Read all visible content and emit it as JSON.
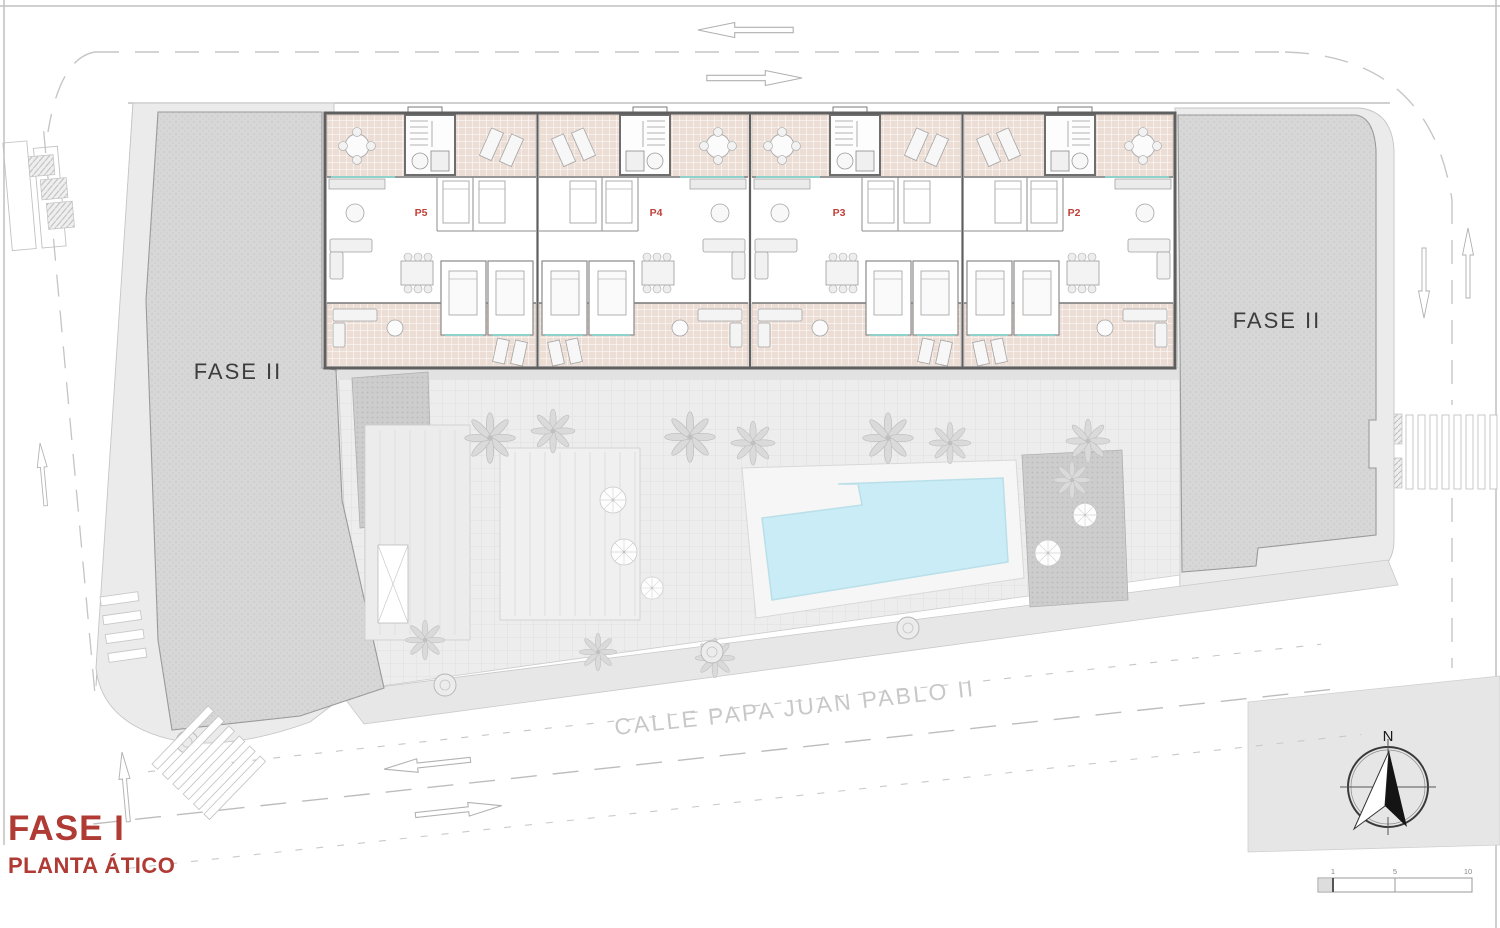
{
  "plan": {
    "title_phase": "FASE I",
    "title_floor": "PLANTA ÁTICO",
    "street_name": "CALLE PAPA JUAN PABLO II",
    "phase2_left_label": "FASE II",
    "phase2_right_label": "FASE II",
    "compass_north": "N",
    "units": [
      {
        "id": "P5"
      },
      {
        "id": "P4"
      },
      {
        "id": "P3"
      },
      {
        "id": "P2"
      }
    ],
    "scale_ticks": [
      "1",
      "5",
      "10"
    ],
    "colors": {
      "accent_red": "#b03a34",
      "unit_label_red": "#bf4038",
      "terrace_tile": "#ecddd5",
      "pool_water": "#c9ecf6",
      "phase2_block": "#d7d7d7",
      "paving": "#ededed",
      "window_teal": "#8ed2cb"
    }
  }
}
